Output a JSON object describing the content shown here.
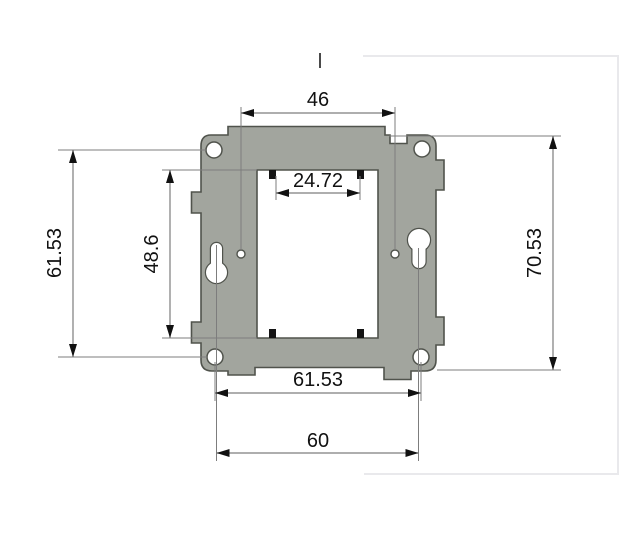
{
  "drawing": {
    "title": "mounting-plate-dimension-drawing",
    "view": "front view of metal mounting plate with keyhole slots and dimension callouts",
    "dimensions": {
      "top_hole_spacing": "46",
      "inner_opening_width": "24.72",
      "left_vertical_hole_spacing": "61.53",
      "inner_opening_height": "48.6",
      "overall_height": "70.53",
      "bottom_hole_spacing": "61.53",
      "keyhole_spacing": "60"
    },
    "features": {
      "corner_holes": 4,
      "keyhole_slots": 2,
      "small_pilot_holes": 2,
      "center_cutout": "rectangular opening with four black corner tabs"
    },
    "colors": {
      "plate_fill": "#a2a59e",
      "plate_outline": "#50534c",
      "dimension_line": "#7d7d7d",
      "arrowhead": "#111111",
      "text": "#111111",
      "frame_border": "#e9e9ec",
      "background": "#ffffff"
    }
  }
}
